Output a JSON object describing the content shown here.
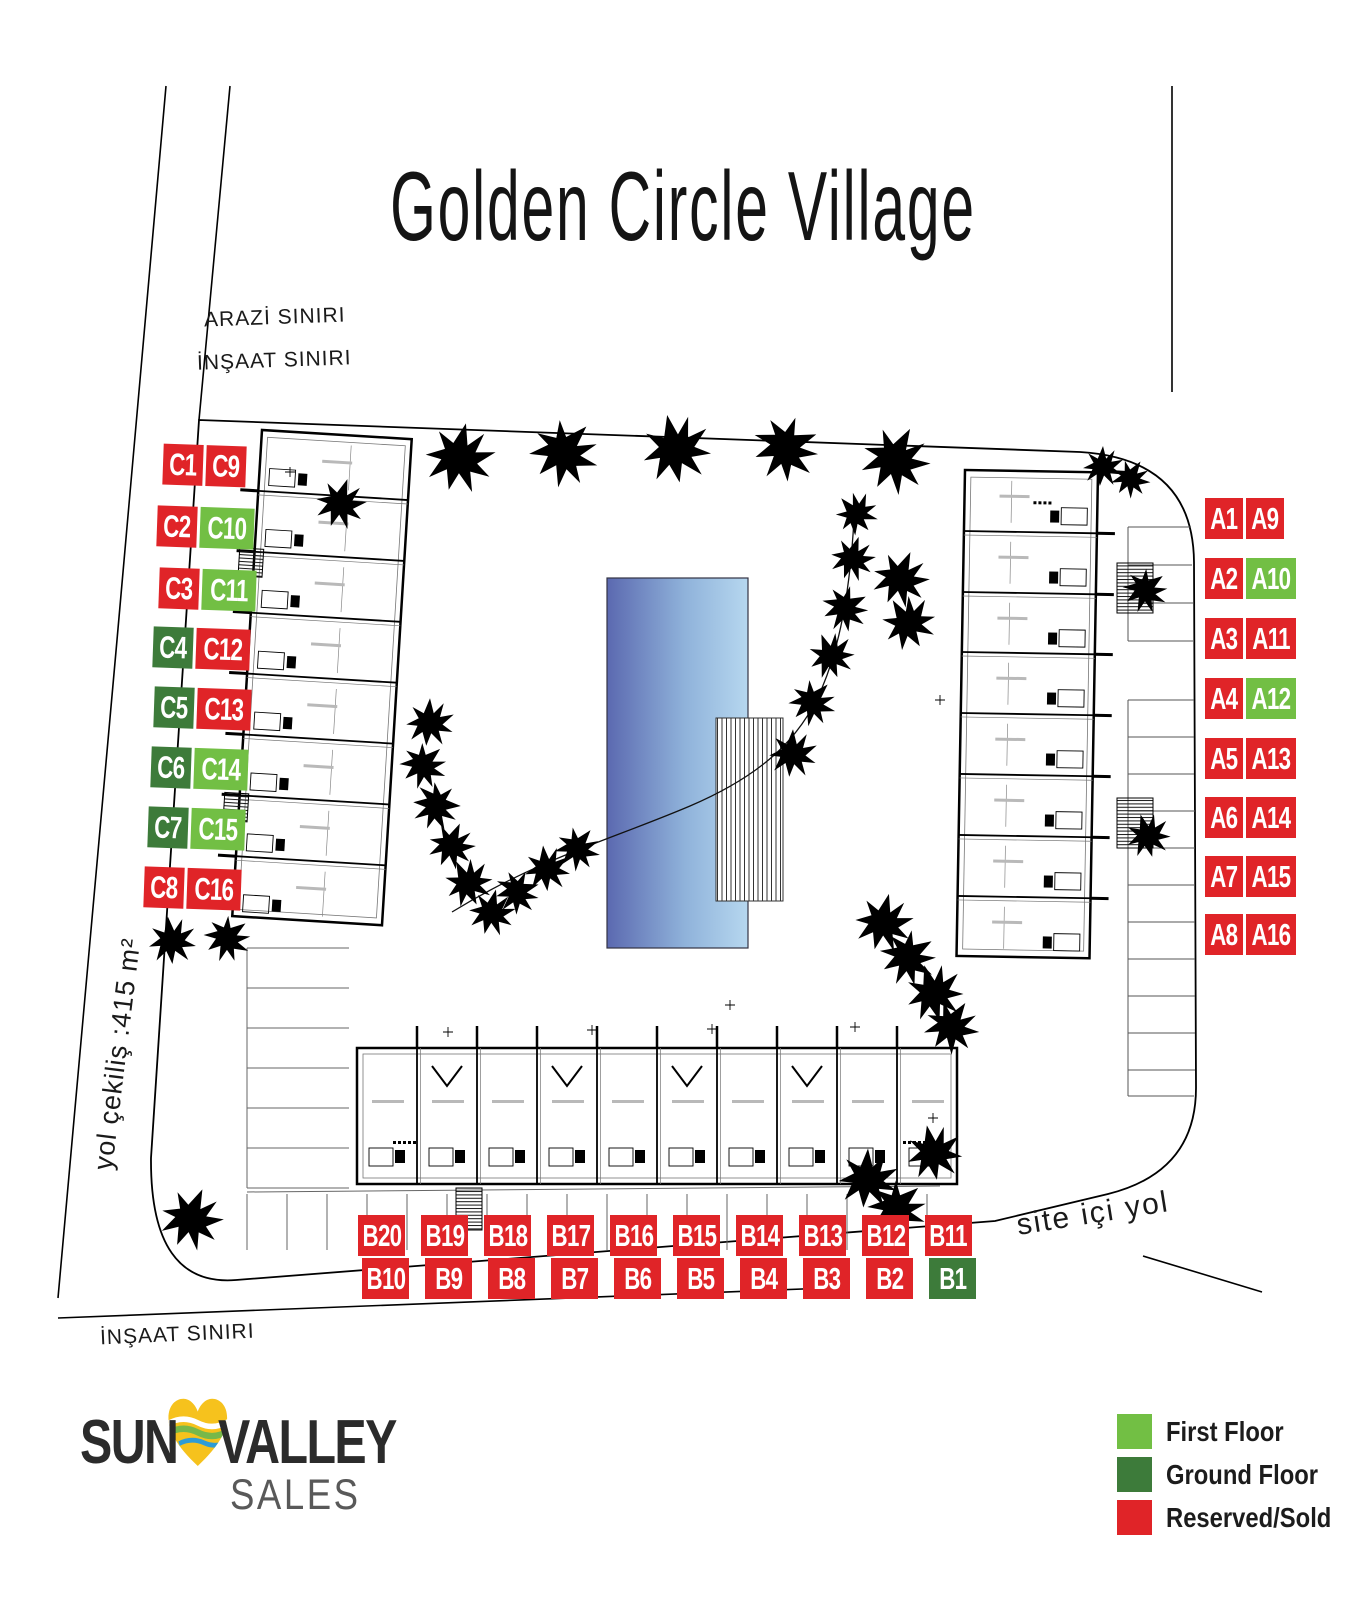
{
  "title": "Golden Circle Village",
  "map_labels": {
    "arazi_siniri": "ARAZİ SINIRI",
    "insaat_siniri_top": "İNŞAAT SINIRI",
    "insaat_siniri_bottom": "İNŞAAT SINIRI",
    "yol_cekilis": "yol çekiliş :415 m²",
    "site_ici_yol": "site içi yol"
  },
  "colors": {
    "first_floor": "#72bf44",
    "ground_floor": "#3d7b3a",
    "reserved_sold": "#e02428",
    "pool_left": "#5b69b0",
    "pool_right": "#b6d7ef"
  },
  "legend": {
    "items": [
      {
        "label": "First Floor",
        "status": "first_floor"
      },
      {
        "label": "Ground Floor",
        "status": "ground_floor"
      },
      {
        "label": "Reserved/Sold",
        "status": "reserved_sold"
      }
    ]
  },
  "logo": {
    "part1": "SUN",
    "part2": "VALLEY",
    "line2": "SALES",
    "heart_icon": "heart-with-waves"
  },
  "units": {
    "c_block_rows": [
      [
        {
          "label": "C1",
          "status": "reserved_sold"
        },
        {
          "label": "C9",
          "status": "reserved_sold"
        }
      ],
      [
        {
          "label": "C2",
          "status": "reserved_sold"
        },
        {
          "label": "C10",
          "status": "first_floor"
        }
      ],
      [
        {
          "label": "C3",
          "status": "reserved_sold"
        },
        {
          "label": "C11",
          "status": "first_floor"
        }
      ],
      [
        {
          "label": "C4",
          "status": "ground_floor"
        },
        {
          "label": "C12",
          "status": "reserved_sold"
        }
      ],
      [
        {
          "label": "C5",
          "status": "ground_floor"
        },
        {
          "label": "C13",
          "status": "reserved_sold"
        }
      ],
      [
        {
          "label": "C6",
          "status": "ground_floor"
        },
        {
          "label": "C14",
          "status": "first_floor"
        }
      ],
      [
        {
          "label": "C7",
          "status": "ground_floor"
        },
        {
          "label": "C15",
          "status": "first_floor"
        }
      ],
      [
        {
          "label": "C8",
          "status": "reserved_sold"
        },
        {
          "label": "C16",
          "status": "reserved_sold"
        }
      ]
    ],
    "a_block_rows": [
      [
        {
          "label": "A1",
          "status": "reserved_sold"
        },
        {
          "label": "A9",
          "status": "reserved_sold"
        }
      ],
      [
        {
          "label": "A2",
          "status": "reserved_sold"
        },
        {
          "label": "A10",
          "status": "first_floor"
        }
      ],
      [
        {
          "label": "A3",
          "status": "reserved_sold"
        },
        {
          "label": "A11",
          "status": "reserved_sold"
        }
      ],
      [
        {
          "label": "A4",
          "status": "reserved_sold"
        },
        {
          "label": "A12",
          "status": "first_floor"
        }
      ],
      [
        {
          "label": "A5",
          "status": "reserved_sold"
        },
        {
          "label": "A13",
          "status": "reserved_sold"
        }
      ],
      [
        {
          "label": "A6",
          "status": "reserved_sold"
        },
        {
          "label": "A14",
          "status": "reserved_sold"
        }
      ],
      [
        {
          "label": "A7",
          "status": "reserved_sold"
        },
        {
          "label": "A15",
          "status": "reserved_sold"
        }
      ],
      [
        {
          "label": "A8",
          "status": "reserved_sold"
        },
        {
          "label": "A16",
          "status": "reserved_sold"
        }
      ]
    ],
    "b_block_rows": {
      "upper": [
        {
          "label": "B20",
          "status": "reserved_sold"
        },
        {
          "label": "B19",
          "status": "reserved_sold"
        },
        {
          "label": "B18",
          "status": "reserved_sold"
        },
        {
          "label": "B17",
          "status": "reserved_sold"
        },
        {
          "label": "B16",
          "status": "reserved_sold"
        },
        {
          "label": "B15",
          "status": "reserved_sold"
        },
        {
          "label": "B14",
          "status": "reserved_sold"
        },
        {
          "label": "B13",
          "status": "reserved_sold"
        },
        {
          "label": "B12",
          "status": "reserved_sold"
        },
        {
          "label": "B11",
          "status": "reserved_sold"
        }
      ],
      "lower": [
        {
          "label": "B10",
          "status": "reserved_sold"
        },
        {
          "label": "B9",
          "status": "reserved_sold"
        },
        {
          "label": "B8",
          "status": "reserved_sold"
        },
        {
          "label": "B7",
          "status": "reserved_sold"
        },
        {
          "label": "B6",
          "status": "reserved_sold"
        },
        {
          "label": "B5",
          "status": "reserved_sold"
        },
        {
          "label": "B4",
          "status": "reserved_sold"
        },
        {
          "label": "B3",
          "status": "reserved_sold"
        },
        {
          "label": "B2",
          "status": "reserved_sold"
        },
        {
          "label": "B1",
          "status": "ground_floor"
        }
      ]
    }
  }
}
